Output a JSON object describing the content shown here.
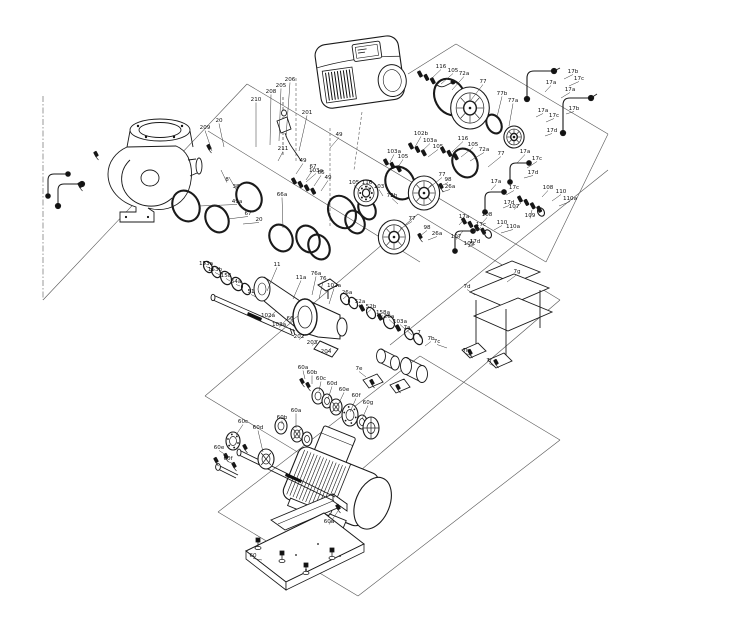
{
  "page": {
    "background": "#ffffff"
  },
  "diagram": {
    "description": "exploded-view-parts-diagram-of-inline-pump",
    "ink": "#1a1a1a",
    "labels": [
      {
        "t": "209",
        "x": 205,
        "y": 129,
        "tx": 212,
        "ty": 151
      },
      {
        "t": "20",
        "x": 219,
        "y": 122,
        "tx": 224,
        "ty": 147
      },
      {
        "t": "210",
        "x": 256,
        "y": 101,
        "tx": 256,
        "ty": 147
      },
      {
        "t": "208",
        "x": 271,
        "y": 93,
        "tx": 270,
        "ty": 145
      },
      {
        "t": "205",
        "x": 281,
        "y": 87,
        "tx": 279,
        "ty": 141
      },
      {
        "t": "206",
        "x": 290,
        "y": 81,
        "tx": 286,
        "ty": 137
      },
      {
        "t": "201",
        "x": 307,
        "y": 114,
        "tx": 299,
        "ty": 151
      },
      {
        "t": "211",
        "x": 283,
        "y": 150,
        "tx": 278,
        "ty": 161
      },
      {
        "t": "8",
        "x": 227,
        "y": 181,
        "tx": 221,
        "ty": 170
      },
      {
        "t": "38",
        "x": 236,
        "y": 188,
        "tx": 229,
        "ty": 177
      },
      {
        "t": "49a",
        "x": 237,
        "y": 203,
        "tx": 199,
        "ty": 206
      },
      {
        "t": "67",
        "x": 248,
        "y": 215,
        "tx": 228,
        "ty": 219
      },
      {
        "t": "20",
        "x": 259,
        "y": 221,
        "tx": 243,
        "ty": 224
      },
      {
        "t": "49",
        "x": 339,
        "y": 136,
        "tx": 330,
        "ty": 148
      },
      {
        "t": "49",
        "x": 303,
        "y": 162,
        "tx": 296,
        "ty": 174
      },
      {
        "t": "67",
        "x": 313,
        "y": 168,
        "tx": 306,
        "ty": 180
      },
      {
        "t": "66",
        "x": 321,
        "y": 174,
        "tx": 314,
        "ty": 186
      },
      {
        "t": "49",
        "x": 328,
        "y": 179,
        "tx": 321,
        "ty": 191
      },
      {
        "t": "66a",
        "x": 282,
        "y": 196,
        "tx": 283,
        "ty": 228
      },
      {
        "t": "103a",
        "x": 316,
        "y": 172,
        "tx": 306,
        "ty": 182
      },
      {
        "t": "116",
        "x": 441,
        "y": 68,
        "tx": 431,
        "ty": 79
      },
      {
        "t": "105",
        "x": 453,
        "y": 72,
        "tx": 441,
        "ty": 84
      },
      {
        "t": "72a",
        "x": 464,
        "y": 75,
        "tx": 452,
        "ty": 90
      },
      {
        "t": "77",
        "x": 483,
        "y": 83,
        "tx": 471,
        "ty": 100
      },
      {
        "t": "77b",
        "x": 502,
        "y": 95,
        "tx": 497,
        "ty": 117
      },
      {
        "t": "77a",
        "x": 513,
        "y": 102,
        "tx": 509,
        "ty": 126
      },
      {
        "t": "17b",
        "x": 573,
        "y": 73,
        "tx": 564,
        "ty": 79
      },
      {
        "t": "17c",
        "x": 579,
        "y": 80,
        "tx": 569,
        "ty": 86
      },
      {
        "t": "17a",
        "x": 551,
        "y": 84,
        "tx": 545,
        "ty": 92
      },
      {
        "t": "17a",
        "x": 570,
        "y": 91,
        "tx": 561,
        "ty": 98
      },
      {
        "t": "17b",
        "x": 574,
        "y": 110,
        "tx": 566,
        "ty": 114
      },
      {
        "t": "17a",
        "x": 543,
        "y": 112,
        "tx": 536,
        "ty": 117
      },
      {
        "t": "17c",
        "x": 554,
        "y": 117,
        "tx": 546,
        "ty": 122
      },
      {
        "t": "17d",
        "x": 552,
        "y": 132,
        "tx": 545,
        "ty": 136
      },
      {
        "t": "102b",
        "x": 421,
        "y": 135,
        "tx": 415,
        "ty": 147
      },
      {
        "t": "103a",
        "x": 430,
        "y": 142,
        "tx": 421,
        "ty": 152
      },
      {
        "t": "105",
        "x": 438,
        "y": 148,
        "tx": 428,
        "ty": 157
      },
      {
        "t": "116",
        "x": 463,
        "y": 140,
        "tx": 452,
        "ty": 152
      },
      {
        "t": "105",
        "x": 473,
        "y": 146,
        "tx": 461,
        "ty": 157
      },
      {
        "t": "72a",
        "x": 484,
        "y": 151,
        "tx": 470,
        "ty": 161
      },
      {
        "t": "77",
        "x": 501,
        "y": 155,
        "tx": 488,
        "ty": 167
      },
      {
        "t": "17a",
        "x": 525,
        "y": 153,
        "tx": 517,
        "ty": 163
      },
      {
        "t": "17c",
        "x": 537,
        "y": 160,
        "tx": 527,
        "ty": 168
      },
      {
        "t": "17d",
        "x": 533,
        "y": 174,
        "tx": 524,
        "ty": 178
      },
      {
        "t": "103a",
        "x": 394,
        "y": 153,
        "tx": 390,
        "ty": 162
      },
      {
        "t": "105",
        "x": 403,
        "y": 158,
        "tx": 398,
        "ty": 167
      },
      {
        "t": "105",
        "x": 354,
        "y": 184,
        "tx": 360,
        "ty": 191
      },
      {
        "t": "116",
        "x": 367,
        "y": 184,
        "tx": 371,
        "ty": 192
      },
      {
        "t": "103",
        "x": 379,
        "y": 188,
        "tx": 383,
        "ty": 196
      },
      {
        "t": "72b",
        "x": 392,
        "y": 197,
        "tx": 398,
        "ty": 204
      },
      {
        "t": "98",
        "x": 448,
        "y": 181,
        "tx": 441,
        "ty": 186
      },
      {
        "t": "26a",
        "x": 450,
        "y": 188,
        "tx": 442,
        "ty": 192
      },
      {
        "t": "77",
        "x": 442,
        "y": 176,
        "tx": 430,
        "ty": 187
      },
      {
        "t": "77",
        "x": 412,
        "y": 220,
        "tx": 400,
        "ty": 229
      },
      {
        "t": "98",
        "x": 427,
        "y": 229,
        "tx": 420,
        "ty": 236
      },
      {
        "t": "26a",
        "x": 437,
        "y": 235,
        "tx": 428,
        "ty": 240
      },
      {
        "t": "17a",
        "x": 496,
        "y": 183,
        "tx": 491,
        "ty": 190
      },
      {
        "t": "17c",
        "x": 514,
        "y": 189,
        "tx": 506,
        "ty": 195
      },
      {
        "t": "17d",
        "x": 509,
        "y": 204,
        "tx": 503,
        "ty": 208
      },
      {
        "t": "17a",
        "x": 464,
        "y": 218,
        "tx": 459,
        "ty": 225
      },
      {
        "t": "17c",
        "x": 481,
        "y": 226,
        "tx": 473,
        "ty": 232
      },
      {
        "t": "17d",
        "x": 475,
        "y": 243,
        "tx": 468,
        "ty": 247
      },
      {
        "t": "108",
        "x": 548,
        "y": 189,
        "tx": 542,
        "ty": 197
      },
      {
        "t": "110",
        "x": 561,
        "y": 193,
        "tx": 552,
        "ty": 201
      },
      {
        "t": "110a",
        "x": 570,
        "y": 200,
        "tx": 559,
        "ty": 206
      },
      {
        "t": "107",
        "x": 514,
        "y": 208,
        "tx": 521,
        "ty": 203
      },
      {
        "t": "109",
        "x": 530,
        "y": 217,
        "tx": 532,
        "ty": 210
      },
      {
        "t": "108",
        "x": 487,
        "y": 216,
        "tx": 483,
        "ty": 222
      },
      {
        "t": "110",
        "x": 502,
        "y": 224,
        "tx": 494,
        "ty": 230
      },
      {
        "t": "110a",
        "x": 513,
        "y": 228,
        "tx": 501,
        "ty": 233
      },
      {
        "t": "107",
        "x": 456,
        "y": 238,
        "tx": 463,
        "ty": 231
      },
      {
        "t": "109",
        "x": 469,
        "y": 245,
        "tx": 472,
        "ty": 239
      },
      {
        "t": "153a",
        "x": 206,
        "y": 265,
        "tx": 212,
        "ty": 269
      },
      {
        "t": "153b",
        "x": 215,
        "y": 271,
        "tx": 220,
        "ty": 275
      },
      {
        "t": "158",
        "x": 226,
        "y": 277,
        "tx": 230,
        "ty": 281
      },
      {
        "t": "64a",
        "x": 236,
        "y": 283,
        "tx": 240,
        "ty": 286
      },
      {
        "t": "51",
        "x": 251,
        "y": 293,
        "tx": 256,
        "ty": 297
      },
      {
        "t": "11",
        "x": 277,
        "y": 266,
        "tx": 267,
        "ty": 291
      },
      {
        "t": "11a",
        "x": 301,
        "y": 279,
        "tx": 293,
        "ty": 299
      },
      {
        "t": "76a",
        "x": 316,
        "y": 275,
        "tx": 312,
        "ty": 295
      },
      {
        "t": "76",
        "x": 323,
        "y": 280,
        "tx": 319,
        "ty": 299
      },
      {
        "t": "102a",
        "x": 334,
        "y": 287,
        "tx": 329,
        "ty": 304
      },
      {
        "t": "26a",
        "x": 347,
        "y": 294,
        "tx": 343,
        "ty": 299
      },
      {
        "t": "52a",
        "x": 360,
        "y": 303,
        "tx": 356,
        "ty": 308
      },
      {
        "t": "52b",
        "x": 371,
        "y": 308,
        "tx": 367,
        "ty": 313
      },
      {
        "t": "158a",
        "x": 383,
        "y": 314,
        "tx": 378,
        "ty": 319
      },
      {
        "t": "102a",
        "x": 268,
        "y": 317,
        "tx": 276,
        "ty": 311
      },
      {
        "t": "103a",
        "x": 279,
        "y": 326,
        "tx": 287,
        "ty": 319
      },
      {
        "t": "66",
        "x": 290,
        "y": 320,
        "tx": 298,
        "ty": 316
      },
      {
        "t": "202",
        "x": 299,
        "y": 338,
        "tx": 306,
        "ty": 334
      },
      {
        "t": "203",
        "x": 312,
        "y": 344,
        "tx": 318,
        "ty": 340
      },
      {
        "t": "204",
        "x": 326,
        "y": 353,
        "tx": 331,
        "ty": 348
      },
      {
        "t": "26a",
        "x": 389,
        "y": 318,
        "tx": 394,
        "ty": 324
      },
      {
        "t": "103a",
        "x": 400,
        "y": 323,
        "tx": 405,
        "ty": 329
      },
      {
        "t": "7a",
        "x": 407,
        "y": 329,
        "tx": 412,
        "ty": 335
      },
      {
        "t": "7",
        "x": 419,
        "y": 334,
        "tx": 423,
        "ty": 340
      },
      {
        "t": "7b",
        "x": 431,
        "y": 340,
        "tx": 425,
        "ty": 346
      },
      {
        "t": "7e",
        "x": 359,
        "y": 370,
        "tx": 366,
        "ty": 377
      },
      {
        "t": "7d",
        "x": 467,
        "y": 288,
        "tx": 475,
        "ty": 295
      },
      {
        "t": "7g",
        "x": 517,
        "y": 273,
        "tx": 507,
        "ty": 282
      },
      {
        "t": "7c",
        "x": 437,
        "y": 343,
        "tx": 447,
        "ty": 348
      },
      {
        "t": "7h",
        "x": 466,
        "y": 352,
        "tx": 472,
        "ty": 356
      },
      {
        "t": "7f",
        "x": 489,
        "y": 362,
        "tx": 494,
        "ty": 366
      },
      {
        "t": "60a",
        "x": 303,
        "y": 369,
        "tx": 305,
        "ty": 379
      },
      {
        "t": "60b",
        "x": 312,
        "y": 374,
        "tx": 312,
        "ty": 384
      },
      {
        "t": "60c",
        "x": 321,
        "y": 380,
        "tx": 319,
        "ty": 391
      },
      {
        "t": "60d",
        "x": 332,
        "y": 385,
        "tx": 328,
        "ty": 399
      },
      {
        "t": "60e",
        "x": 344,
        "y": 391,
        "tx": 338,
        "ty": 405
      },
      {
        "t": "60f",
        "x": 356,
        "y": 397,
        "tx": 350,
        "ty": 412
      },
      {
        "t": "60g",
        "x": 368,
        "y": 404,
        "tx": 362,
        "ty": 419
      },
      {
        "t": "60c",
        "x": 243,
        "y": 423,
        "tx": 236,
        "ty": 435
      },
      {
        "t": "60b",
        "x": 282,
        "y": 419,
        "tx": 282,
        "ty": 424
      },
      {
        "t": "60a",
        "x": 296,
        "y": 412,
        "tx": 296,
        "ty": 428
      },
      {
        "t": "60d",
        "x": 258,
        "y": 429,
        "tx": 263,
        "ty": 452
      },
      {
        "t": "60e",
        "x": 219,
        "y": 449,
        "tx": 226,
        "ty": 455
      },
      {
        "t": "60f",
        "x": 228,
        "y": 460,
        "tx": 234,
        "ty": 464
      },
      {
        "t": "60a",
        "x": 329,
        "y": 523,
        "tx": 338,
        "ty": 511
      },
      {
        "t": "60",
        "x": 253,
        "y": 557,
        "tx": 262,
        "ty": 560
      }
    ]
  }
}
